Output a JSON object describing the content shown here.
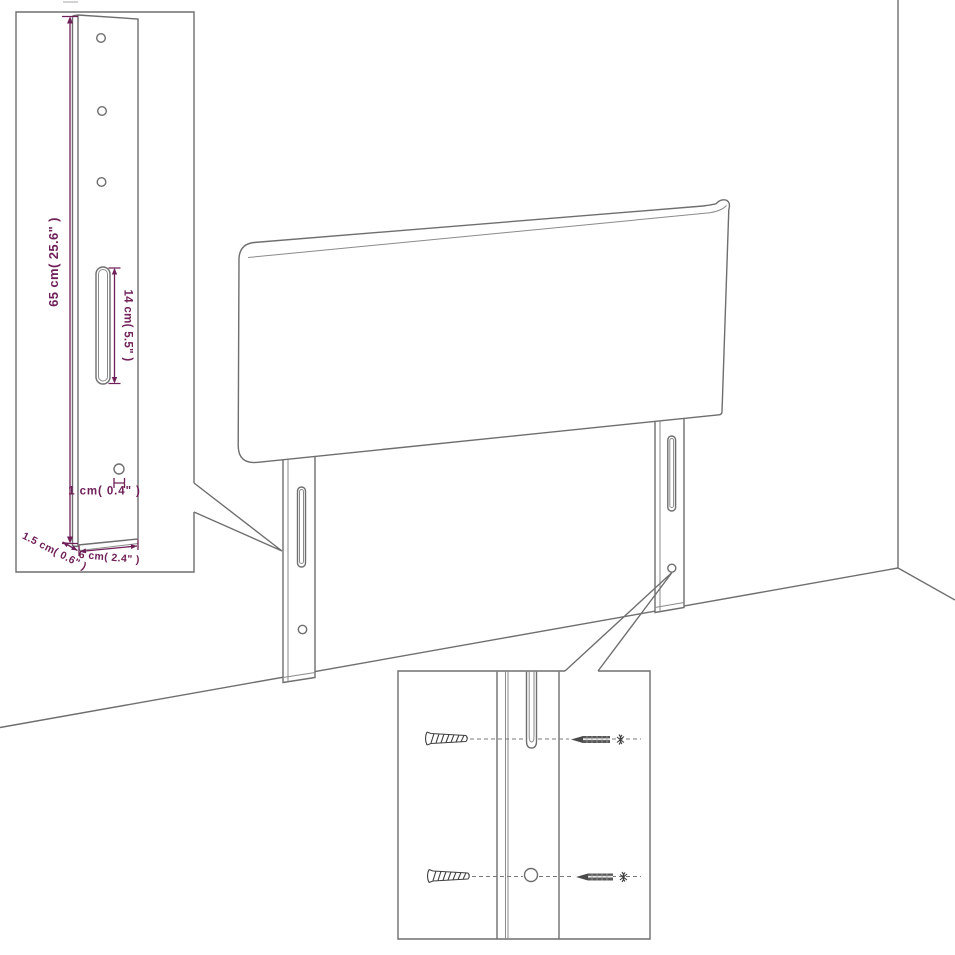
{
  "diagram": {
    "type": "product-dimension-diagram",
    "subject": "upholstered headboard with two mounting legs",
    "labels": {
      "height": "65 cm( 25.6\" )",
      "slot": "14 cm( 5.5\" )",
      "hole": "1 cm( 0.4\" )",
      "depth": "1.5 cm( 0.6\" )",
      "width": "6 cm( 2.4\" )"
    },
    "colors": {
      "line": "#6e6e6e",
      "dimension": "#6f2058",
      "background": "#ffffff"
    }
  }
}
